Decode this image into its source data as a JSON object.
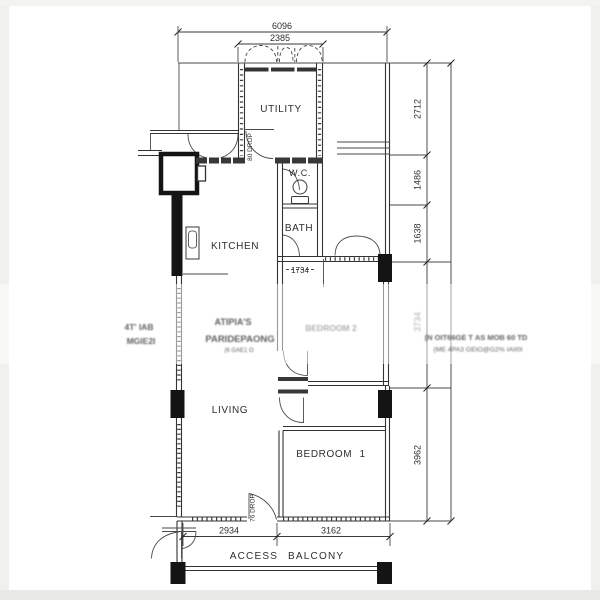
{
  "plan": {
    "rooms": {
      "utility": "UTILITY",
      "wc": "W.C.",
      "bath": "BATH",
      "kitchen": "KITCHEN",
      "living": "LIVING",
      "bedroom1": "BEDROOM 1"
    },
    "dimensions": {
      "overall_width": "6096",
      "utility_width": "2385",
      "right_1": "2712",
      "right_2": "1486",
      "right_3": "1638",
      "right_4_blurred": "3734",
      "right_5": "3962",
      "bottom_left": "2934",
      "bottom_right": "3162",
      "interior": "1734"
    },
    "annotations": {
      "drop_utility": "80 DROP",
      "drop_entrance": "76 DROP",
      "access_balcony": "ACCESS BALCONY"
    },
    "watermarks": {
      "left_line1": "4T' IAB",
      "left_line2": "MGIE2I",
      "center_line1": "ATIPIA'S",
      "center_line2": "PARIDEPAONG",
      "center_line3": "(6 GAE1 O",
      "bedroom2_blurred": "BEDROOM 2",
      "right_line1": "(N OIT66GE T AS MOB 60 TD",
      "right_line2": "(ME 4PA3 GEIO@G2% IAII0I"
    }
  }
}
